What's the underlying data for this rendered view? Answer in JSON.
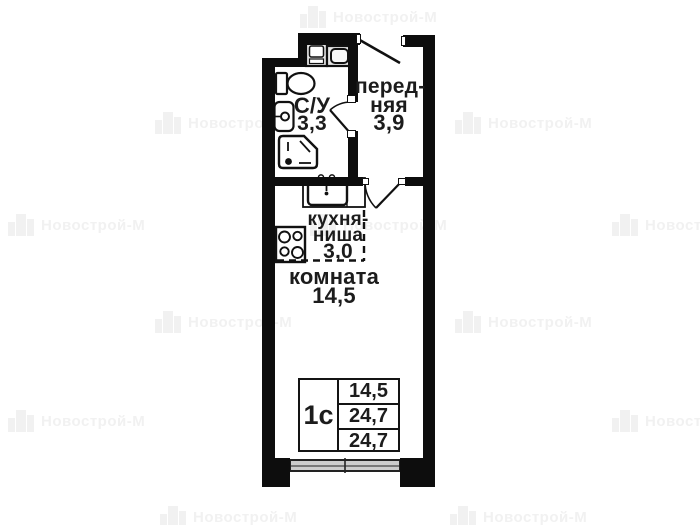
{
  "watermark": {
    "text": "Новострой-М"
  },
  "rooms": {
    "bathroom": {
      "name": "С/У",
      "area": "3,3"
    },
    "hall": {
      "name_line1": "перед-",
      "name_line2": "няя",
      "area": "3,9"
    },
    "kitchen": {
      "name_line1": "кухня-",
      "name_line2": "ниша",
      "area": "3,0"
    },
    "living": {
      "name": "комната",
      "area": "14,5"
    }
  },
  "spec_table": {
    "type": "1с",
    "rows": [
      "14,5",
      "24,7",
      "24,7"
    ]
  },
  "fixtures": [
    "toilet",
    "bathroom-sink",
    "shower",
    "washing-machine",
    "dryer",
    "kitchen-sink",
    "stove",
    "window",
    "entrance-door",
    "bathroom-door",
    "room-door",
    "kitchen-niche-dashed-boundary"
  ],
  "colors": {
    "wall": "#0d0d0d",
    "watermark": "#f1f1f1",
    "window_fill": "#cccccc"
  }
}
